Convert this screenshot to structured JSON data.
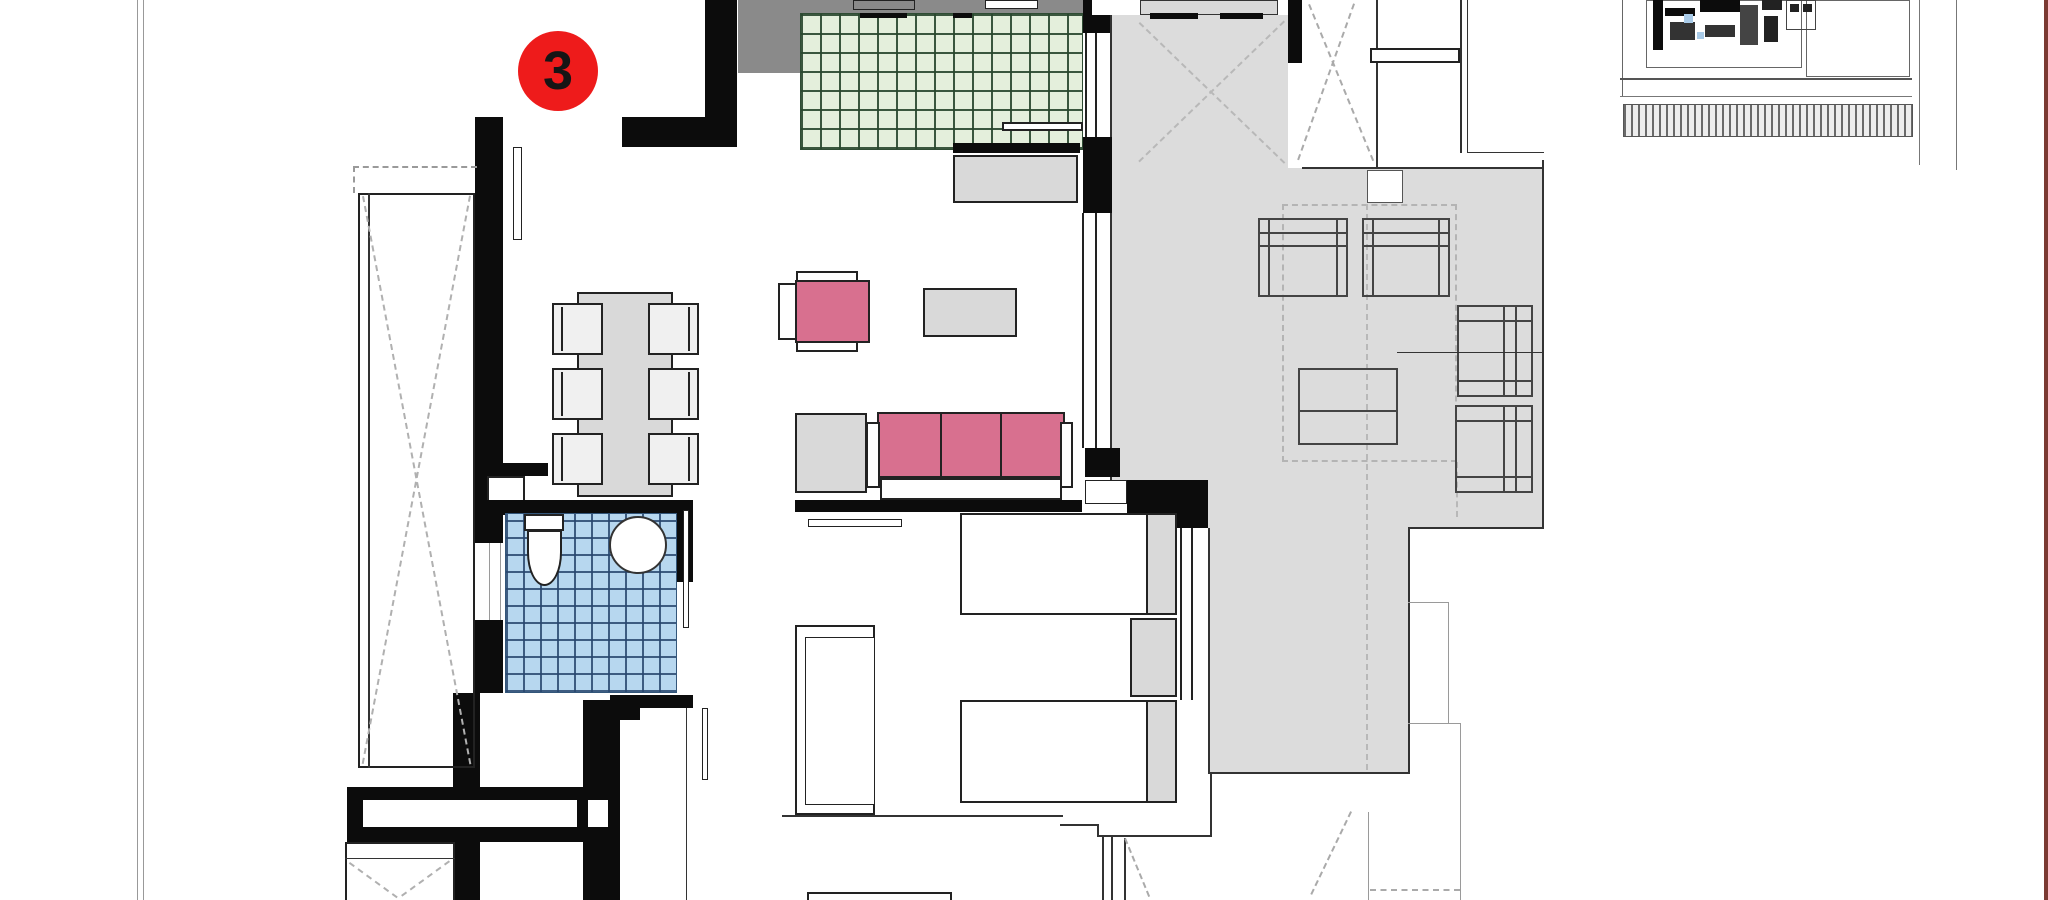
{
  "unit_badge": {
    "label": "3"
  },
  "palette": {
    "badge_red": "#ee1b1b",
    "wall_black": "#0c0c0c",
    "kitchen_tile_fill": "#e4efdc",
    "kitchen_tile_grid": "#2f4c34",
    "bathroom_tile_fill": "#b7d7ef",
    "bathroom_tile_grid": "#33567a",
    "upholstery_pink": "#d8708f",
    "furniture_gray": "#d9d9d9",
    "counter_dark_gray": "#8a8a8a",
    "terrace_gray": "#dcdcdc",
    "outline_dark": "#222222",
    "neighbor_outline_gray": "#9a9a9a",
    "page_edge_maroon": "#7b3a33"
  }
}
